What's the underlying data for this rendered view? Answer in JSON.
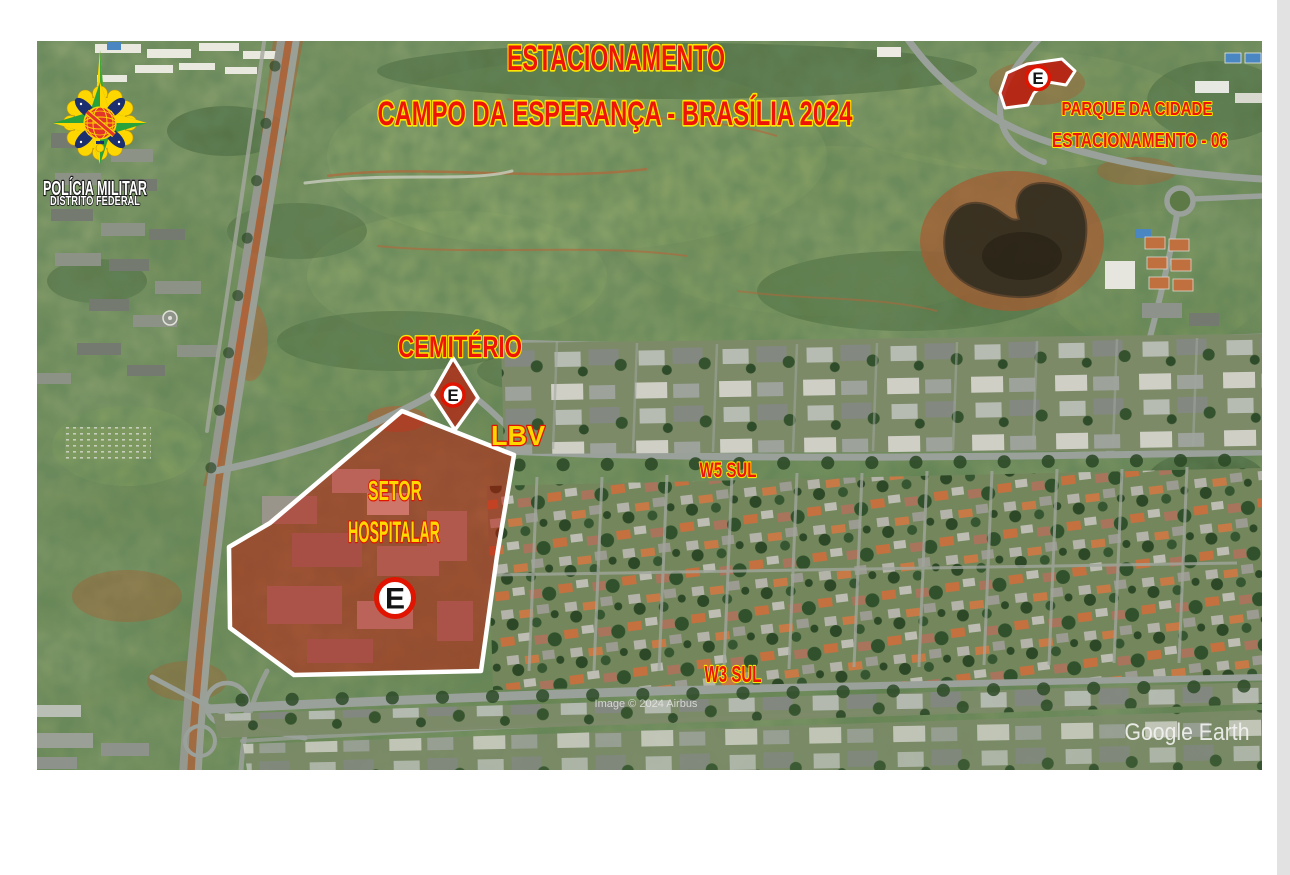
{
  "header": {
    "title_line1": "ESTACIONAMENTO",
    "title_line2": "CAMPO DA ESPERANÇA - BRASÍLIA 2024"
  },
  "badge": {
    "org_name": "POLÍCIA MILITAR",
    "org_subtitle": "DISTRITO FEDERAL"
  },
  "map": {
    "parking_symbol": "E",
    "zones": {
      "setor_hospitalar": {
        "label_line1": "SETOR",
        "label_line2": "HOSPITALAR"
      },
      "cemiterio": {
        "label": "CEMITÉRIO"
      },
      "parque_da_cidade": {
        "label_line1": "PARQUE DA CIDADE",
        "label_line2": "ESTACIONAMENTO - 06"
      }
    },
    "street_labels": {
      "lbv": "LBV",
      "w5": "W5 SUL",
      "w3": "W3 SUL"
    },
    "source": {
      "attribution": "Image © 2024 Airbus",
      "watermark": "Google Earth"
    },
    "colors": {
      "zone_fill": "#c01408",
      "zone_border": "#ffffff",
      "label_red": "#ee1408",
      "label_yellow": "#ffd800",
      "label_outline_yellow": "#ffe600",
      "label_outline_red": "#e01400",
      "sign_ring_red": "#e01400"
    }
  }
}
